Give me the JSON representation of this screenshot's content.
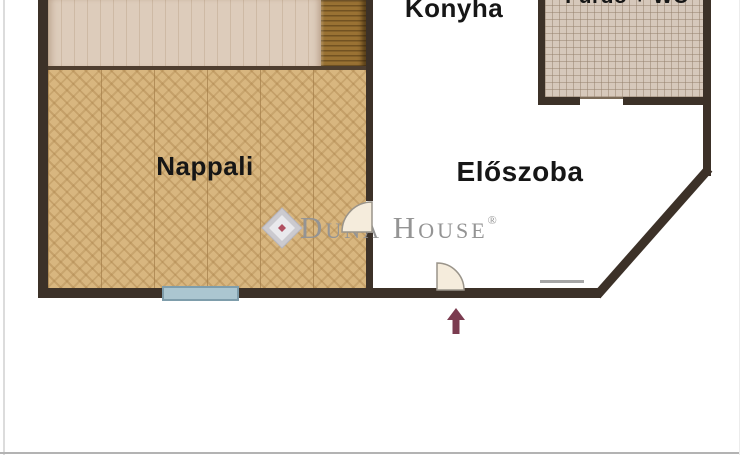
{
  "rooms": {
    "nappali": {
      "label": "Nappali"
    },
    "eloszoba": {
      "label": "Előszoba"
    },
    "konyha": {
      "label": "Konyha"
    },
    "furdo": {
      "label": "Fürdő + WC"
    }
  },
  "watermark": {
    "brand": "Duna House",
    "registered": "®"
  },
  "colors": {
    "wall": "#3c3128",
    "parquet": "#d8b67f",
    "carpet": "#ddccbb",
    "wood_strip": "#9a7233",
    "tile": "#d6c8bb",
    "window": "#abc6d0",
    "window_border": "#7e9dab",
    "door_leaf": "#f5ecdc",
    "door_outline": "#9a948a",
    "threshold": "#a6a6a6",
    "arrow": "#7b3c50",
    "watermark_gray": "#949494"
  }
}
